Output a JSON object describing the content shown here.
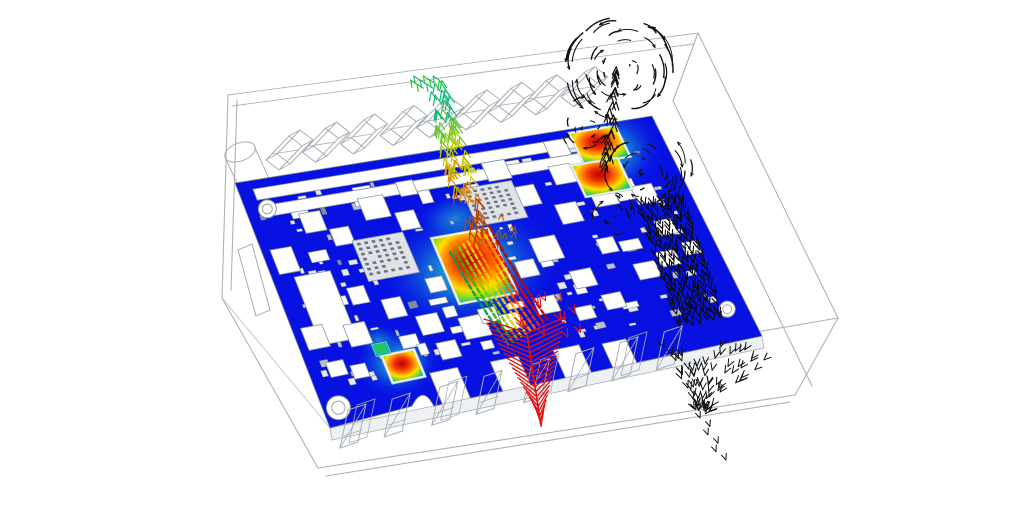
{
  "scene": {
    "kind": "pcb-thermal-cfd-simulation",
    "background": "#ffffff",
    "wireframe_color": "#a8aeb6",
    "enclosure": {
      "lines": [
        [
          228,
          95,
          698,
          33
        ],
        [
          232,
          106,
          693,
          44
        ],
        [
          698,
          33,
          838,
          318
        ],
        [
          698,
          33,
          673,
          101
        ],
        [
          673,
          101,
          812,
          386
        ],
        [
          228,
          95,
          222,
          298
        ],
        [
          237,
          100,
          231,
          290
        ],
        [
          222,
          298,
          318,
          468
        ],
        [
          318,
          468,
          795,
          395
        ],
        [
          326,
          476,
          790,
          402
        ],
        [
          795,
          395,
          838,
          318
        ],
        [
          838,
          318,
          640,
          352
        ],
        [
          222,
          298,
          330,
          428
        ]
      ]
    },
    "board": {
      "surface_color": "#0712e2",
      "outline_stroke": "#7e8996",
      "quad": {
        "bl": [
          235,
          183
        ],
        "br": [
          652,
          116
        ],
        "fr": [
          762,
          336
        ],
        "fl": [
          330,
          428
        ]
      },
      "skirt_color": "#eef1f4",
      "slot_bars": [
        [
          0.035,
          0.035,
          0.79,
          0.045
        ],
        [
          0.035,
          0.105,
          0.79,
          0.045
        ]
      ],
      "notches": [
        [
          0.26,
          0.87,
          0.065,
          0.14
        ],
        [
          0.4,
          0.875,
          0.065,
          0.13
        ],
        [
          0.545,
          0.88,
          0.06,
          0.125
        ],
        [
          0.655,
          0.895,
          0.055,
          0.11
        ]
      ],
      "arch_notch": {
        "a": 0.215,
        "r": 11
      },
      "holes": [
        {
          "a": 0.05,
          "b": 0.12,
          "r": 9
        },
        {
          "a": 0.035,
          "b": 0.93,
          "r": 12
        },
        {
          "a": 0.955,
          "b": 0.86,
          "r": 8
        }
      ],
      "edge_bar": [
        [
          238,
          250
        ],
        [
          252,
          244
        ],
        [
          270,
          310
        ],
        [
          256,
          316
        ]
      ],
      "components": [
        [
          0.02,
          0.28,
          0.05,
          0.1,
          "w"
        ],
        [
          0.05,
          0.4,
          0.085,
          0.28,
          "w"
        ],
        [
          0.02,
          0.6,
          0.05,
          0.09,
          "w"
        ],
        [
          0.115,
          0.16,
          0.05,
          0.08,
          "w"
        ],
        [
          0.17,
          0.24,
          0.045,
          0.07,
          "w"
        ],
        [
          0.115,
          0.62,
          0.05,
          0.09,
          "w"
        ],
        [
          0.155,
          0.48,
          0.04,
          0.07,
          "w"
        ],
        [
          0.22,
          0.55,
          0.045,
          0.08,
          "w"
        ],
        [
          0.26,
          0.14,
          0.06,
          0.09,
          "w"
        ],
        [
          0.28,
          0.64,
          0.05,
          0.08,
          "w"
        ],
        [
          0.3,
          0.76,
          0.045,
          0.07,
          "w"
        ],
        [
          0.33,
          0.22,
          0.045,
          0.075,
          "w"
        ],
        [
          0.36,
          0.1,
          0.04,
          0.06,
          "w"
        ],
        [
          0.37,
          0.68,
          0.06,
          0.09,
          "w"
        ],
        [
          0.46,
          0.7,
          0.045,
          0.065,
          "w"
        ],
        [
          0.545,
          0.5,
          0.045,
          0.07,
          "w"
        ],
        [
          0.55,
          0.66,
          0.05,
          0.07,
          "w"
        ],
        [
          0.57,
          0.08,
          0.055,
          0.08,
          "w"
        ],
        [
          0.615,
          0.2,
          0.05,
          0.085,
          "w"
        ],
        [
          0.6,
          0.42,
          0.06,
          0.1,
          "w"
        ],
        [
          0.655,
          0.58,
          0.05,
          0.075,
          "w"
        ],
        [
          0.69,
          0.3,
          0.05,
          0.085,
          "w"
        ],
        [
          0.715,
          0.14,
          0.05,
          0.08,
          "w"
        ],
        [
          0.7,
          0.7,
          0.045,
          0.065,
          "w"
        ],
        [
          0.745,
          0.47,
          0.04,
          0.065,
          "w"
        ],
        [
          0.78,
          0.25,
          0.055,
          0.09,
          "w"
        ],
        [
          0.8,
          0.6,
          0.05,
          0.07,
          "w"
        ],
        [
          0.73,
          0.035,
          0.05,
          0.07,
          "w"
        ],
        [
          0.875,
          0.28,
          0.05,
          0.08,
          "w"
        ],
        [
          0.89,
          0.44,
          0.042,
          0.065,
          "w"
        ],
        [
          0.86,
          0.57,
          0.045,
          0.065,
          "w"
        ],
        [
          0.925,
          0.55,
          0.035,
          0.055,
          "w"
        ],
        [
          0.42,
          0.66,
          0.04,
          0.06,
          "w"
        ],
        [
          0.63,
          0.73,
          0.04,
          0.055,
          "w"
        ],
        [
          0.335,
          0.5,
          0.04,
          0.06,
          "w"
        ],
        [
          0.045,
          0.75,
          0.04,
          0.06,
          "w"
        ],
        [
          0.095,
          0.78,
          0.035,
          0.055,
          "w"
        ],
        [
          0.21,
          0.3,
          0.12,
          0.17,
          "g"
        ],
        [
          0.5,
          0.17,
          0.12,
          0.16,
          "g"
        ],
        [
          0.39,
          0.35,
          0.13,
          0.27,
          "hot"
        ],
        [
          0.8,
          0.02,
          0.105,
          0.13,
          "hot"
        ],
        [
          0.77,
          0.155,
          0.105,
          0.13,
          "hot"
        ],
        [
          0.175,
          0.77,
          0.07,
          0.105,
          "hot"
        ],
        [
          0.16,
          0.715,
          0.035,
          0.05,
          "mini"
        ]
      ],
      "pads": {
        "count": 120,
        "seed": 13
      },
      "small_comps": {
        "count": 26,
        "seed": 5
      }
    },
    "halos": [
      {
        "cx": 470,
        "cy": 268,
        "rx": 92,
        "ry": 62,
        "rot": -10,
        "opacity": 1.0
      },
      {
        "cx": 455,
        "cy": 218,
        "rx": 40,
        "ry": 26,
        "rot": -10,
        "opacity": 0.55
      },
      {
        "cx": 607,
        "cy": 152,
        "rx": 56,
        "ry": 46,
        "rot": -8,
        "opacity": 0.95
      },
      {
        "cx": 398,
        "cy": 362,
        "rx": 44,
        "ry": 36,
        "rot": -8,
        "opacity": 0.9
      },
      {
        "cx": 378,
        "cy": 340,
        "rx": 22,
        "ry": 17,
        "rot": 0,
        "opacity": 0.5
      }
    ],
    "gradients": {
      "hot_chip": [
        [
          "0%",
          "#b80300"
        ],
        [
          "28%",
          "#ee2e00"
        ],
        [
          "50%",
          "#ff8a00"
        ],
        [
          "66%",
          "#ffdf00"
        ],
        [
          "80%",
          "#9bdc10"
        ],
        [
          "92%",
          "#34c878"
        ],
        [
          "100%",
          "#22b4b0"
        ]
      ],
      "mini_chip": [
        [
          "0%",
          "#28c838"
        ],
        [
          "55%",
          "#1cc08c"
        ],
        [
          "100%",
          "#15b4c8"
        ]
      ],
      "halo": [
        [
          "0%",
          "#37e0c8"
        ],
        [
          "45%",
          "#18b4d4"
        ],
        [
          "100%",
          "#0712e2"
        ]
      ]
    },
    "plumes": {
      "thermal_column": {
        "spine": [
          [
            480,
            238
          ],
          [
            452,
            150
          ],
          [
            437,
            78
          ]
        ],
        "count": 95,
        "seed": 21,
        "colors": [
          "#b44700",
          "#e08c00",
          "#c2cc00",
          "#66c832",
          "#16b87e",
          "#2cc22c"
        ]
      },
      "rainbow_band": {
        "start": [
          470,
          240
        ],
        "dir": [
          58,
          92
        ],
        "stripes": 10,
        "spacing": 5.2,
        "colors": [
          "#009a60",
          "#2bb400",
          "#7ccc00",
          "#c8d800",
          "#ffd400",
          "#ff9c00",
          "#ff5a00",
          "#f02800",
          "#dc0c00",
          "#c80000"
        ]
      },
      "red_jet": {
        "top": [
          527,
          333
        ],
        "apex": [
          541,
          426
        ],
        "rows": 20,
        "color": "#e01212",
        "scatter": {
          "count": 14,
          "x": 498,
          "y": 300,
          "w": 88,
          "h": 42,
          "seed": 3
        }
      },
      "black_mushroom": {
        "color": "#101010",
        "seed": 9,
        "stem": {
          "from": [
            608,
            162
          ],
          "to": [
            616,
            66
          ],
          "count": 26
        },
        "blobs": [
          {
            "cx": 622,
            "cy": 70,
            "rx": 58,
            "ry": 52,
            "n": 48
          },
          {
            "cx": 586,
            "cy": 126,
            "rx": 26,
            "ry": 30,
            "n": 14
          },
          {
            "cx": 642,
            "cy": 172,
            "rx": 52,
            "ry": 38,
            "n": 28
          },
          {
            "cx": 612,
            "cy": 214,
            "rx": 30,
            "ry": 22,
            "n": 12
          }
        ]
      },
      "black_band": {
        "color": "#0a0a0a",
        "top": [
          660,
          200
        ],
        "bottom": [
          700,
          320
        ],
        "rows": 26,
        "cols": 7,
        "col_step": 7,
        "seed": 4
      },
      "black_cone": {
        "color": "#111111",
        "edge_a": [
          658,
          340
        ],
        "edge_b": [
          778,
          352
        ],
        "apex": [
          700,
          420
        ],
        "count": 80,
        "seed": 6,
        "trail": [
          [
            700,
            418
          ],
          [
            745,
            436
          ],
          [
            720,
            460
          ]
        ]
      }
    },
    "cap_row": {
      "start": [
        283,
        152
      ],
      "end": [
        600,
        84
      ],
      "positions": [
        0,
        0.115,
        0.235,
        0.36,
        0.475,
        0.59,
        0.7,
        0.81,
        0.93
      ]
    },
    "connector_row": {
      "start": [
        352,
        444
      ],
      "end": [
        692,
        360
      ],
      "positions": [
        0,
        0.13,
        0.27,
        0.4,
        0.54,
        0.67,
        0.8,
        0.93
      ]
    },
    "cylinder": {
      "e1": [
        240,
        152
      ],
      "e2": [
        262,
        200
      ],
      "rx": 16,
      "ry": 9,
      "rot": -20
    }
  }
}
